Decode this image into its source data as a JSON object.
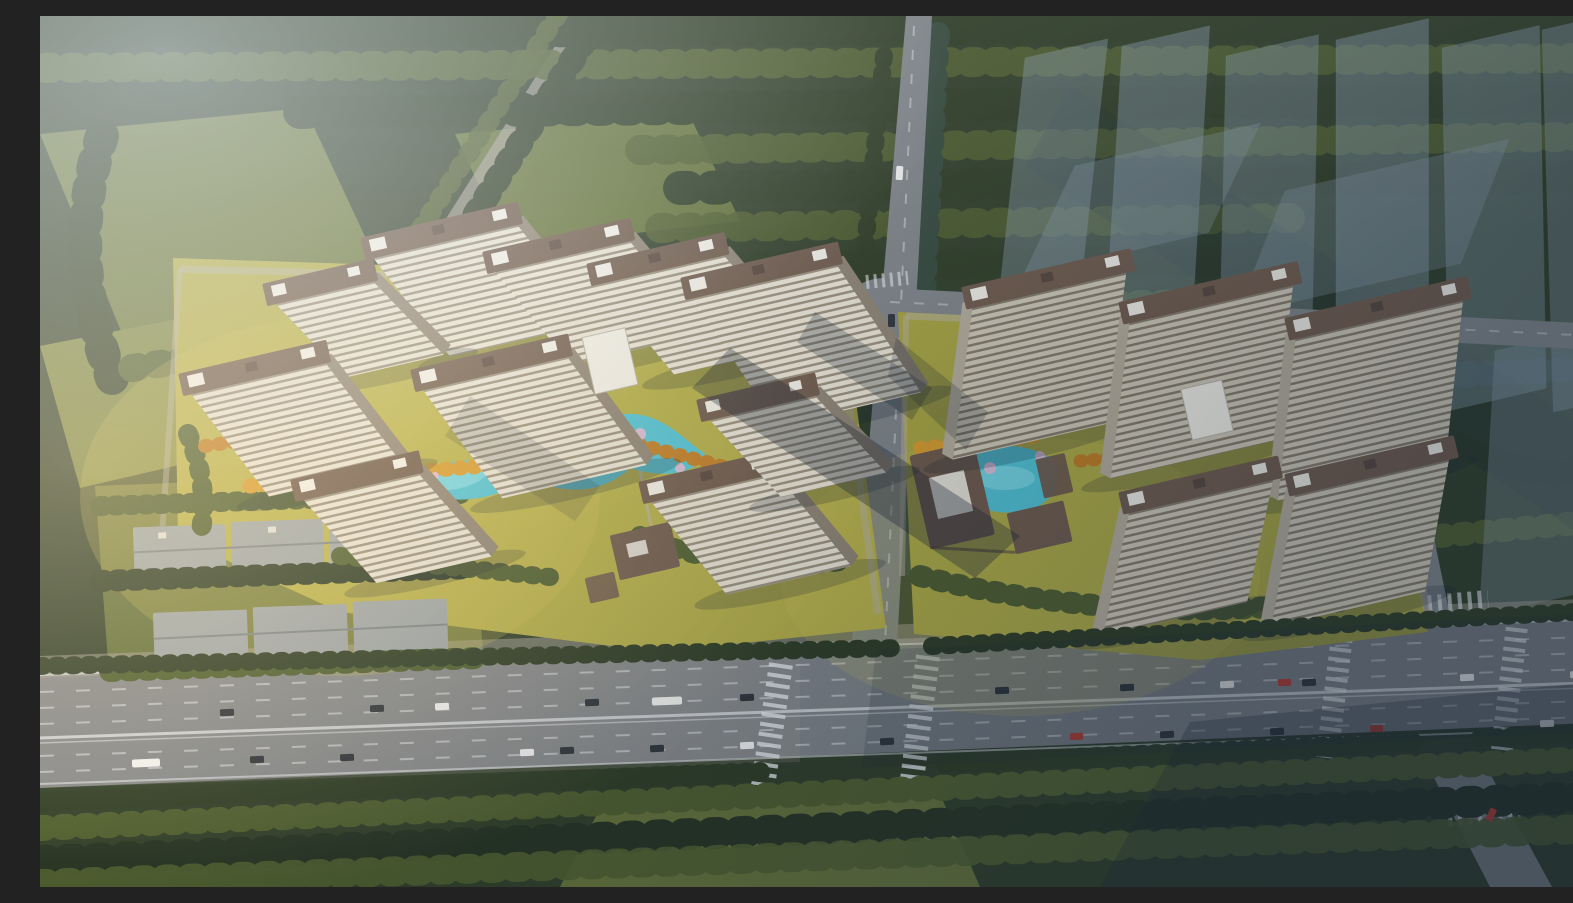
{
  "image": {
    "kind": "3d-aerial-architectural-rendering",
    "subject": "Bird's-eye rendering of a two-parcel residential development with slab high-rise towers, brown-roof clubhouses, turquoise landscape ponds, autumn-yellow and olive trees, a wide tree-lined boulevard with traffic in the foreground, low gray warehouse rows at lower left, dark forest surroundings and translucent ghosted future towers at the upper right",
    "visible_text": ""
  },
  "palette": {
    "forestBase": "#2e3c26",
    "forestDark": "#243120",
    "canopyBlue": "#33473a",
    "treeDark": "#2c3a22",
    "treeOlive": "#4c5c2c",
    "treeYellow": "#d89b2b",
    "treeOrange": "#c07c20",
    "blossomPink": "#e4bcd6",
    "fieldGreen": "#68753a",
    "fieldBright": "#79833e",
    "lawnLeft": "#b3ad45",
    "lawnRight": "#a6a33f",
    "lawnGold": "#cfc155",
    "water": "#4fc3d4",
    "waterLight": "#86dde8",
    "road": "#7e8387",
    "roadWarm": "#a29d92",
    "laneWhite": "#e9ecef",
    "pathPale": "#b7b0a0",
    "facade": "#e9e3d4",
    "facadeStripe": "#998f7c",
    "facadeShade": "#cfc8b6",
    "facadeStripeShade": "#857a68",
    "roofBrown": "#6e594a",
    "roofDark": "#56443a",
    "roofPanel": "#f2efe6",
    "wallBrown": "#8d8272",
    "wallTan": "#b5ac9a",
    "warehouseGray": "#9fa5a6",
    "ghostBlue": "#8fa2b4",
    "shadowNavy": "#16212e",
    "carWhite": "#f2f2f0",
    "carDark": "#2e3338",
    "carRed": "#c23b2e",
    "hazeBlue": "#dfe9f2",
    "sunGold": "#ffe9bf",
    "coolNavy": "#1c2c40"
  }
}
